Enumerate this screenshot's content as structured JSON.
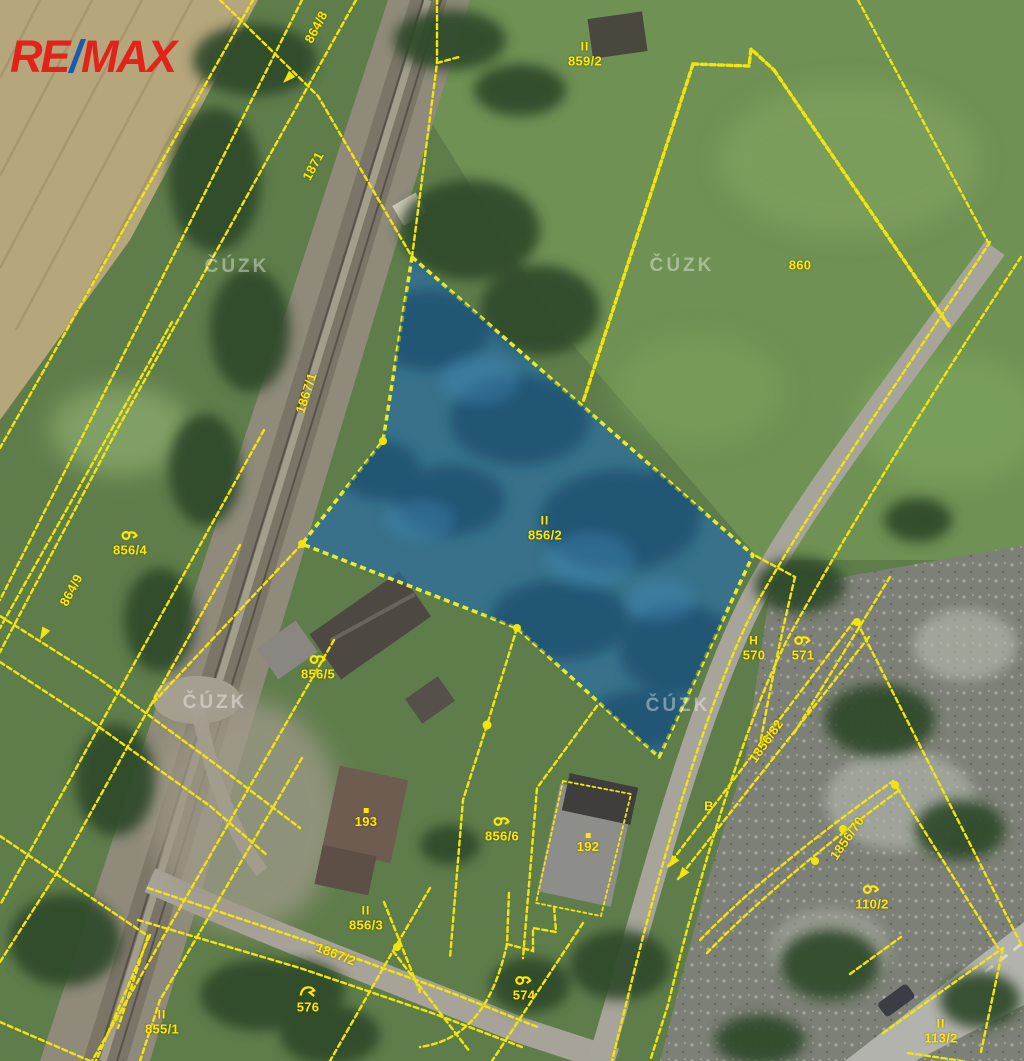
{
  "logo": {
    "part1": "RE",
    "slash": "/",
    "part2": "MAX",
    "red": "#e2231a",
    "blue": "#1b5bab"
  },
  "watermark": {
    "text": "ČÚZK",
    "positions": [
      {
        "x": 237,
        "y": 267
      },
      {
        "x": 682,
        "y": 266
      },
      {
        "x": 215,
        "y": 703
      },
      {
        "x": 678,
        "y": 706
      }
    ]
  },
  "map": {
    "highlighted_parcel": {
      "id": "856/2",
      "fill": "#2a72ad",
      "border": "#e4ee2a"
    },
    "line_color": "#f2e50c",
    "label_color": "#ffe900",
    "marker_glyphs": {
      "II": "II",
      "H": "H"
    },
    "labels": [
      {
        "text": "859/2",
        "marker": "II",
        "x": 585,
        "y": 54
      },
      {
        "text": "860",
        "x": 800,
        "y": 265
      },
      {
        "text": "856/2",
        "marker": "II",
        "x": 545,
        "y": 528
      },
      {
        "text": "856/4",
        "marker": "scrub",
        "x": 130,
        "y": 542
      },
      {
        "text": "856/5",
        "marker": "scrub",
        "x": 318,
        "y": 666
      },
      {
        "text": "193",
        "marker": "dot",
        "x": 366,
        "y": 818
      },
      {
        "text": "856/6",
        "marker": "scrub",
        "x": 502,
        "y": 828
      },
      {
        "text": "192",
        "marker": "dot",
        "x": 588,
        "y": 843
      },
      {
        "text": "856/3",
        "marker": "II",
        "x": 366,
        "y": 918
      },
      {
        "text": "570",
        "marker": "H",
        "x": 754,
        "y": 648
      },
      {
        "text": "571",
        "marker": "scrub",
        "x": 803,
        "y": 647
      },
      {
        "text": "110/2",
        "marker": "scrub",
        "x": 872,
        "y": 896
      },
      {
        "text": "113/2",
        "marker": "II",
        "x": 941,
        "y": 1031
      },
      {
        "text": "855/1",
        "marker": "II",
        "x": 162,
        "y": 1022
      },
      {
        "text": "576",
        "marker": "tree",
        "x": 308,
        "y": 999
      },
      {
        "text": "574",
        "marker": "scrub",
        "x": 524,
        "y": 987
      },
      {
        "text": "B",
        "x": 709,
        "y": 806
      },
      {
        "text": "864/8",
        "x": 316,
        "y": 27,
        "rot": -62
      },
      {
        "text": "1871",
        "x": 313,
        "y": 166,
        "rot": -62
      },
      {
        "text": "1867/1",
        "x": 306,
        "y": 393,
        "rot": -72
      },
      {
        "text": "864/9",
        "x": 71,
        "y": 590,
        "rot": -62
      },
      {
        "text": "1856/82",
        "x": 766,
        "y": 741,
        "rot": -55
      },
      {
        "text": "1856/70",
        "x": 847,
        "y": 838,
        "rot": -55
      },
      {
        "text": "1867/2",
        "x": 336,
        "y": 954,
        "rot": 21
      }
    ]
  }
}
